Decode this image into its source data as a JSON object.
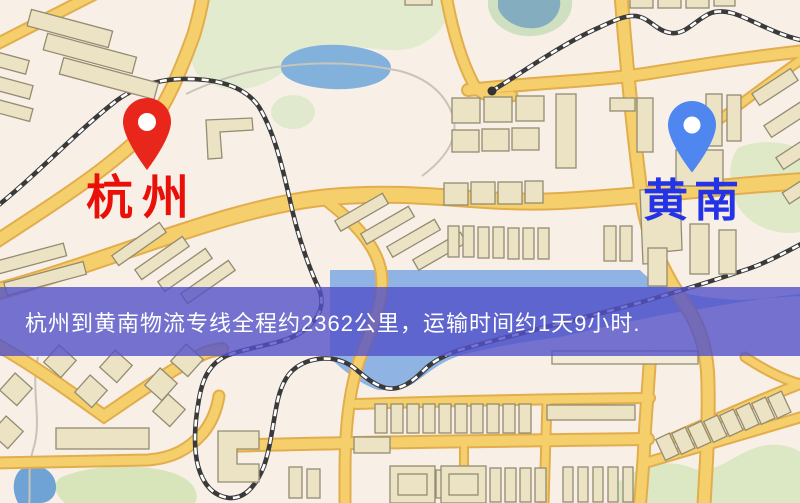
{
  "map": {
    "origin": {
      "label": "杭州",
      "pin_icon": "red-location-pin",
      "pin_color": "#e8261b",
      "label_color": "#ea100a"
    },
    "destination": {
      "label": "黄南",
      "pin_icon": "blue-location-pin",
      "pin_color": "#4f86f0",
      "label_color": "#2433e6"
    },
    "banner": {
      "text": "杭州到黄南物流专线全程约2362公里，运输时间约1天9小时.",
      "background_color": "#5351c9",
      "text_color": "#ffffff"
    },
    "route": {
      "distance_km": "2362",
      "duration": "1天9小时"
    }
  }
}
